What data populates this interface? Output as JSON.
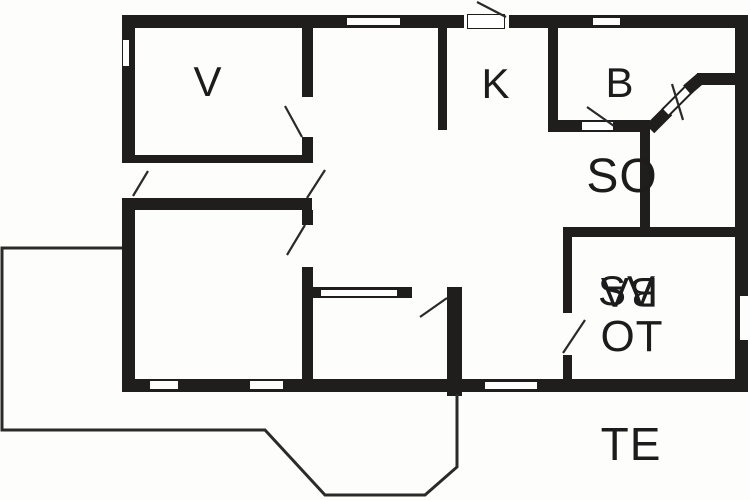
{
  "plan_type": "floor-plan",
  "colors": {
    "wall": "#201d1d",
    "background": "#fdfdfc",
    "thin_line": "#2a2a2a",
    "text": "#1c1c1c"
  },
  "labels": {
    "room_v": "V",
    "room_k": "K",
    "room_b": "B",
    "room_so": "SO",
    "svot_overlay_normal": "SV",
    "svot_overlay_rotated": "BA",
    "room_ot": "OT",
    "terrace": "TE"
  }
}
